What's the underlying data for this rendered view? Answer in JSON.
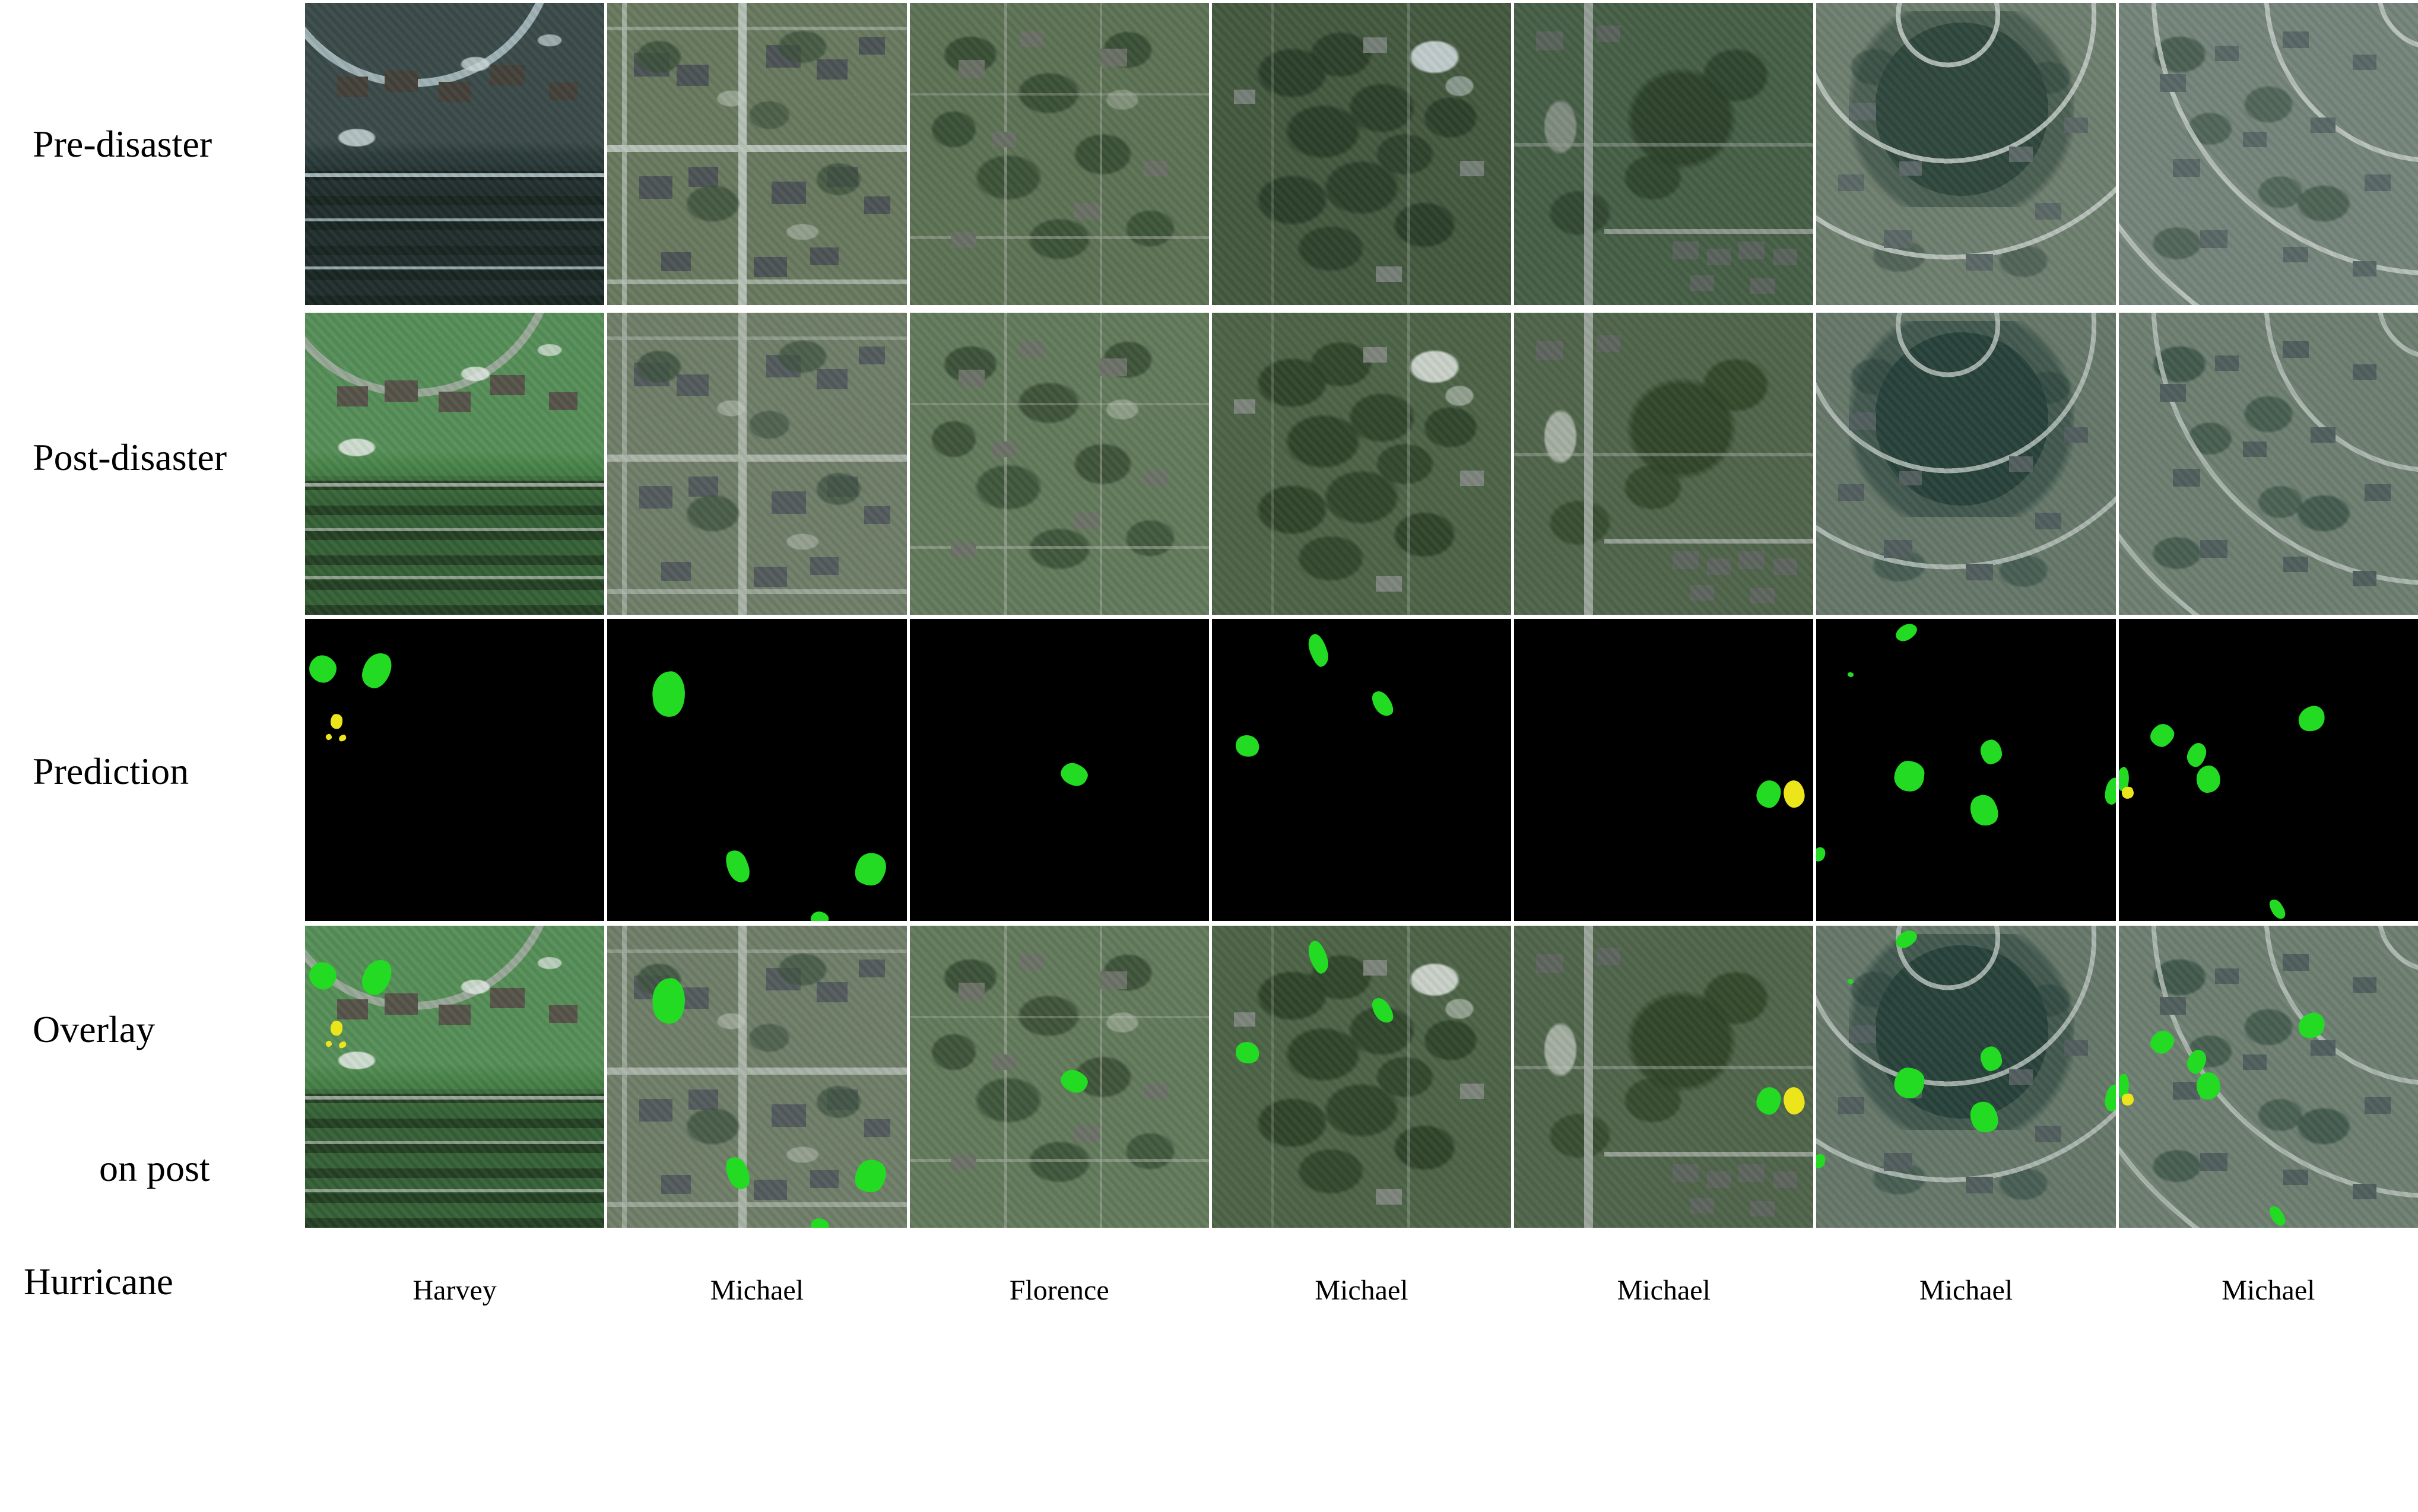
{
  "figure": {
    "row_labels": {
      "pre": "Pre-disaster",
      "post": "Post-disaster",
      "prediction": "Prediction",
      "overlay_line1": "Overlay",
      "overlay_line2": "on post",
      "hurricane": "Hurricane"
    },
    "colors": {
      "background": "#ffffff",
      "prediction_background": "#000000",
      "damage_green": "#23DB23",
      "damage_yellow": "#EDE51C",
      "separator": "#ffffff",
      "label_color": "#000000"
    },
    "columns": [
      {
        "label": "Harvey",
        "pattern": "harvey",
        "pre": {
          "base": "#2c3d3c",
          "road": "#a9bcbf",
          "roof": "#43413a",
          "tree": "#16231e",
          "patch": "#c7d4d6"
        },
        "post": {
          "base": "#49854a",
          "road": "#9fab9e",
          "roof": "#565349",
          "tree": "#20361f",
          "patch": "#e2eae4"
        },
        "blobs": [
          {
            "x": 6,
            "y": 16.5,
            "w": 9,
            "h": 9,
            "c": "green"
          },
          {
            "x": 24,
            "y": 17,
            "w": 9,
            "h": 12,
            "c": "green"
          },
          {
            "x": 10.5,
            "y": 34,
            "w": 4,
            "h": 5,
            "c": "yellow"
          },
          {
            "x": 8,
            "y": 39,
            "w": 2,
            "h": 2,
            "c": "yellow"
          },
          {
            "x": 12.5,
            "y": 39.5,
            "w": 2.5,
            "h": 2,
            "c": "yellow"
          }
        ]
      },
      {
        "label": "Michael",
        "pattern": "grid",
        "pre": {
          "base": "#69795f",
          "road": "#b9c4ba",
          "roof": "#4d5456",
          "tree": "#3a503a",
          "patch": "#c3cec2"
        },
        "post": {
          "base": "#6f7e69",
          "road": "#adb6ab",
          "roof": "#545b5d",
          "tree": "#3d5340",
          "patch": "#c2cabf"
        },
        "blobs": [
          {
            "x": 20.5,
            "y": 25,
            "w": 11,
            "h": 15,
            "c": "green"
          },
          {
            "x": 43.5,
            "y": 82,
            "w": 7,
            "h": 11,
            "c": "green"
          },
          {
            "x": 88,
            "y": 83,
            "w": 10,
            "h": 11,
            "c": "green"
          },
          {
            "x": 71,
            "y": 99.5,
            "w": 6,
            "h": 5,
            "c": "green"
          }
        ]
      },
      {
        "label": "Florence",
        "pattern": "leafy",
        "pre": {
          "base": "#5d7355",
          "road": "#9fa89b",
          "roof": "#6b7066",
          "tree": "#33492f",
          "patch": "#b9c1b3"
        },
        "post": {
          "base": "#637a5b",
          "road": "#a5ad9f",
          "roof": "#6d7268",
          "tree": "#364c33",
          "patch": "#cdd4c8"
        },
        "blobs": [
          {
            "x": 55,
            "y": 51.5,
            "w": 9,
            "h": 7,
            "c": "green"
          }
        ]
      },
      {
        "label": "Michael",
        "pattern": "forest",
        "pre": {
          "base": "#44593f",
          "road": "#8e9a90",
          "roof": "#767f77",
          "tree": "#293d28",
          "patch": "#ccd7d9"
        },
        "post": {
          "base": "#4d6347",
          "road": "#97a197",
          "roof": "#7d857c",
          "tree": "#2d4229",
          "patch": "#d5dcd6"
        },
        "blobs": [
          {
            "x": 35.5,
            "y": 10.5,
            "w": 5.5,
            "h": 11,
            "c": "green"
          },
          {
            "x": 57,
            "y": 28,
            "w": 5.5,
            "h": 9,
            "c": "green"
          },
          {
            "x": 12,
            "y": 42,
            "w": 8,
            "h": 7,
            "c": "green"
          }
        ]
      },
      {
        "label": "Michael",
        "pattern": "road",
        "pre": {
          "base": "#475f46",
          "road": "#98a29b",
          "roof": "#5a625c",
          "tree": "#2b4029",
          "patch": "#8e978f"
        },
        "post": {
          "base": "#4f654a",
          "road": "#a0a99f",
          "roof": "#5e655e",
          "tree": "#2e4426",
          "patch": "#b9c1b7"
        },
        "blobs": [
          {
            "x": 85,
            "y": 58,
            "w": 8,
            "h": 9,
            "c": "green"
          },
          {
            "x": 93.5,
            "y": 58,
            "w": 7,
            "h": 9,
            "c": "yellow"
          }
        ]
      },
      {
        "label": "Michael",
        "pattern": "circular",
        "pre": {
          "base": "#6f7f6f",
          "road": "#c2ccc6",
          "roof": "#5b6967",
          "tree": "#2e463c",
          "patch": "#8f9f93"
        },
        "post": {
          "base": "#66786a",
          "road": "#b5c0ba",
          "roof": "#525f5e",
          "tree": "#26413a",
          "patch": "#a9b5ab"
        },
        "blobs": [
          {
            "x": 30,
            "y": 4.5,
            "w": 7.5,
            "h": 5,
            "c": "green"
          },
          {
            "x": 11.5,
            "y": 18.5,
            "w": 2,
            "h": 1.6,
            "c": "green"
          },
          {
            "x": 31,
            "y": 52,
            "w": 10,
            "h": 10,
            "c": "green"
          },
          {
            "x": 58.5,
            "y": 44,
            "w": 7,
            "h": 8,
            "c": "green"
          },
          {
            "x": 56,
            "y": 63.5,
            "w": 9,
            "h": 10.5,
            "c": "green"
          },
          {
            "x": 1,
            "y": 78,
            "w": 4,
            "h": 5,
            "c": "green"
          },
          {
            "x": 99,
            "y": 57,
            "w": 5,
            "h": 9,
            "c": "green"
          }
        ]
      },
      {
        "label": "Michael",
        "pattern": "curved",
        "pre": {
          "base": "#75857a",
          "road": "#c6cfc9",
          "roof": "#596866",
          "tree": "#3a5243",
          "patch": "#aab8b0"
        },
        "post": {
          "base": "#6e7f72",
          "road": "#b9c3bc",
          "roof": "#505f5d",
          "tree": "#2f4a3d",
          "patch": "#9fafa5"
        },
        "blobs": [
          {
            "x": 1.5,
            "y": 53,
            "w": 4,
            "h": 8,
            "c": "green"
          },
          {
            "x": 3,
            "y": 57.5,
            "w": 4,
            "h": 4,
            "c": "yellow"
          },
          {
            "x": 14.5,
            "y": 38.5,
            "w": 8,
            "h": 7,
            "c": "green"
          },
          {
            "x": 26,
            "y": 45,
            "w": 6,
            "h": 8,
            "c": "green"
          },
          {
            "x": 30,
            "y": 53,
            "w": 8,
            "h": 9,
            "c": "green"
          },
          {
            "x": 64.5,
            "y": 33,
            "w": 9,
            "h": 8,
            "c": "green"
          },
          {
            "x": 53,
            "y": 96,
            "w": 4,
            "h": 7,
            "c": "green"
          }
        ]
      }
    ]
  }
}
